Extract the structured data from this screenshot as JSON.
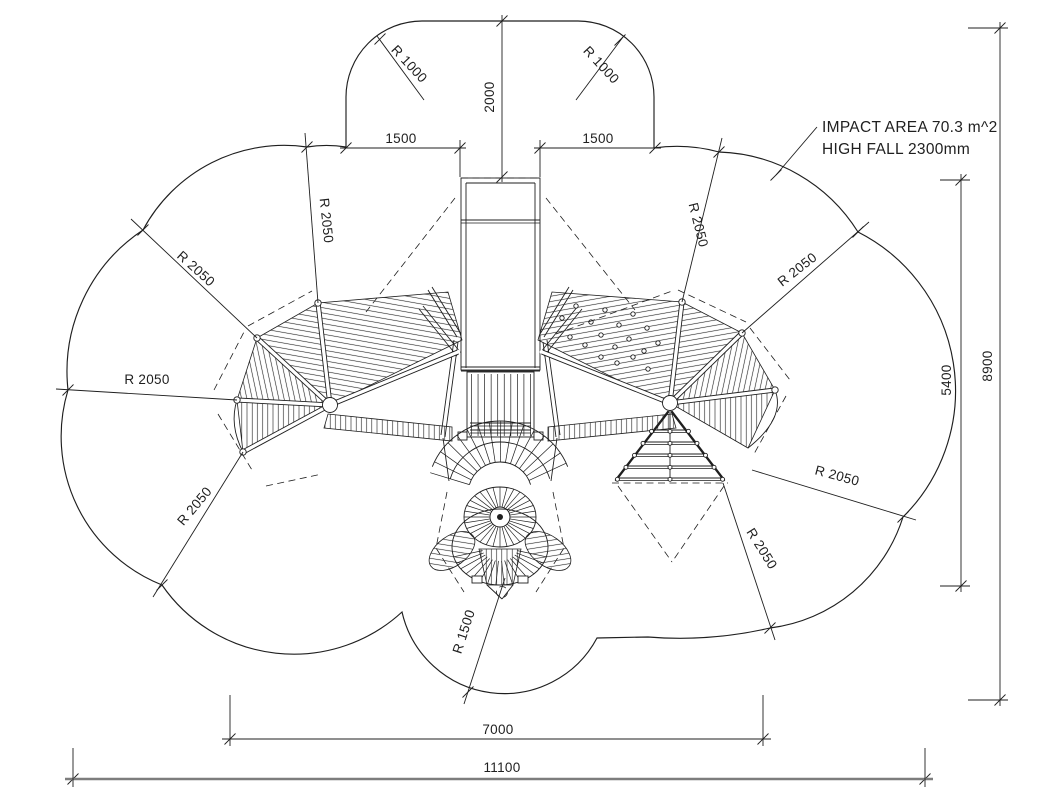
{
  "drawing": {
    "note": {
      "line1": "IMPACT AREA 70.3 m^2",
      "line2": "HIGH FALL 2300mm"
    },
    "dimensions": {
      "slide_projection": "2000",
      "left_offset": "1500",
      "right_offset": "1500",
      "corner_radius_left": "R 1000",
      "corner_radius_right": "R 1000",
      "center_radius": "R 1500",
      "inner_height": "5400",
      "overall_height": "8900",
      "inner_width": "7000",
      "overall_width": "11100",
      "safety_radius_labels": [
        "R 2050",
        "R 2050",
        "R 2050",
        "R 2050",
        "R 2050",
        "R 2050",
        "R 2050",
        "R 2050"
      ]
    },
    "colors": {
      "line": "#1f1f1f",
      "background": "#ffffff",
      "heavy_dim_line": "#7d7d7d"
    }
  }
}
